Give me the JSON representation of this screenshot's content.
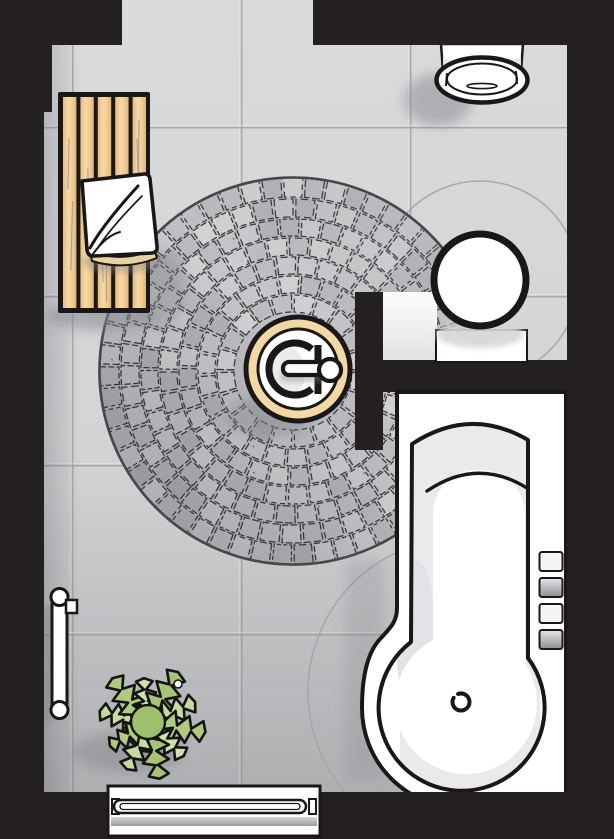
{
  "scene": {
    "type": "bathroom-floor-plan",
    "view": "top-down",
    "objects": [
      {
        "name": "tiled-floor",
        "description": "large square light gray floor tiles"
      },
      {
        "name": "door-opening-top",
        "description": "gap in top wall where floor reaches edge"
      },
      {
        "name": "wooden-slat-bench",
        "description": "bench of five vertical wood slats against left wall"
      },
      {
        "name": "cushion",
        "description": "white folded cushion/towel lying on bench"
      },
      {
        "name": "circular-mosaic-floor",
        "description": "large round cobblestone mosaic inlay"
      },
      {
        "name": "round-basin",
        "description": "round basin with beige rim and swivel tap in mosaic center"
      },
      {
        "name": "partition-wall",
        "description": "T-shaped interior wall stub"
      },
      {
        "name": "pedestal-washbasin",
        "description": "round washbasin on white column at partition"
      },
      {
        "name": "wall-hung-urinal",
        "description": "white fixture hung on top wall"
      },
      {
        "name": "bathtub",
        "description": "round-ended tub with drain, headrest line and four side fittings"
      },
      {
        "name": "towel-rail",
        "description": "vertical rail with round ends on left wall"
      },
      {
        "name": "potted-plant",
        "description": "green fern seen from above"
      },
      {
        "name": "radiator-bench",
        "description": "slatted white radiator bench on bottom wall"
      },
      {
        "name": "clearance-arcs",
        "description": "thin gray clearance circles around washbasin and tub"
      }
    ],
    "counts": {
      "wood_slats": 5,
      "tub_side_fittings": 4,
      "clearance_arcs": 2
    },
    "palette": {
      "wall": "#241f20",
      "outline": "#1a1718",
      "floor_light": "#d7d9db",
      "floor_dark": "#c6c8ca",
      "tile_grout": "#a7a9ab",
      "tile_grout_highlight": "#e8e9ea",
      "mosaic_base": "#bfc1c5",
      "mosaic_joint": "#3b3b3d",
      "mosaic_stones": [
        "#cacccf",
        "#bec0c4",
        "#d1d3d5",
        "#b4b6ba",
        "#c5c7ca",
        "#bbbdc1",
        "#cdced1"
      ],
      "wood": "#f2d19c",
      "wood_streak": "#9aa0a6",
      "cushion_white": "#ffffff",
      "cushion_underside": "#ead2a0",
      "basin_rim": "#f2d9a4",
      "fixture_white": "#ffffff",
      "tub_interior": "#e9eaec",
      "plant_greens": [
        "#c6db9c",
        "#aecb7e",
        "#cfe2aa",
        "#a5c476"
      ],
      "plant_center": "#9dbf6e",
      "shadow": "#85878b",
      "clearance_line": "#a3a6a9"
    }
  }
}
